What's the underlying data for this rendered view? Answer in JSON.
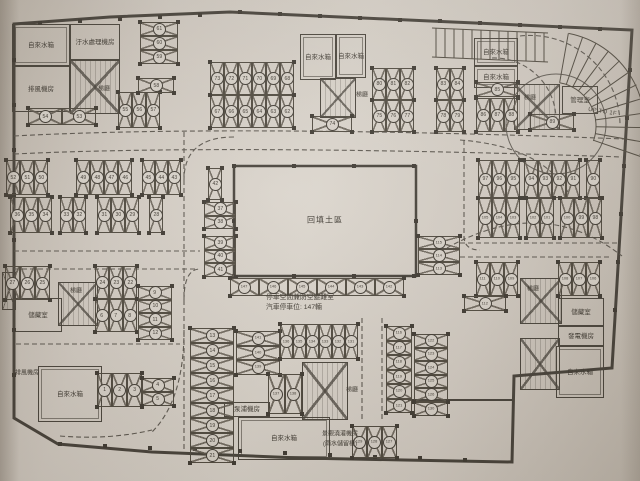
{
  "annotations": {
    "fill_area": "回填土區",
    "shelter": "停車空間兼防空避難室",
    "capacity": "汽車停車位: 147輛",
    "ramp": "UP TO 1F"
  },
  "palette": {
    "paper": "#d6cfc6",
    "ink": "#413c34",
    "dash": "#5b554b"
  },
  "rooms": [
    {
      "label": "自來水箱",
      "x": 12,
      "y": 24,
      "w": 56,
      "h": 40,
      "double": true
    },
    {
      "label": "汙水處理機房",
      "x": 70,
      "y": 24,
      "w": 48,
      "h": 34
    },
    {
      "label": "排風機房",
      "x": 12,
      "y": 66,
      "w": 56,
      "h": 44
    },
    {
      "label": "自來水箱",
      "x": 300,
      "y": 34,
      "w": 34,
      "h": 44,
      "double": true
    },
    {
      "label": "自來水箱",
      "x": 336,
      "y": 34,
      "w": 28,
      "h": 42,
      "double": true
    },
    {
      "label": "自來水箱",
      "x": 474,
      "y": 38,
      "w": 42,
      "h": 26,
      "double": true
    },
    {
      "label": "自來水箱",
      "x": 474,
      "y": 66,
      "w": 42,
      "h": 20,
      "double": true
    },
    {
      "label": "管理室",
      "x": 562,
      "y": 86,
      "w": 34,
      "h": 26
    },
    {
      "label": "儲藏室",
      "x": 558,
      "y": 298,
      "w": 44,
      "h": 26
    },
    {
      "label": "發電機房",
      "x": 558,
      "y": 326,
      "w": 44,
      "h": 18
    },
    {
      "label": "自來水箱",
      "x": 556,
      "y": 346,
      "w": 46,
      "h": 50,
      "double": true
    },
    {
      "label": "儲藏室",
      "x": 14,
      "y": 298,
      "w": 46,
      "h": 32
    },
    {
      "label": "泵浦機房",
      "x": 224,
      "y": 402,
      "w": 44,
      "h": 13
    },
    {
      "label": "自來水箱",
      "x": 238,
      "y": 417,
      "w": 90,
      "h": 41,
      "double": true
    },
    {
      "label": "自來水箱",
      "x": 38,
      "y": 366,
      "w": 62,
      "h": 54,
      "double": true
    }
  ],
  "cores": [
    {
      "x": 70,
      "y": 60,
      "w": 48,
      "h": 52
    },
    {
      "x": 320,
      "y": 78,
      "w": 34,
      "h": 38
    },
    {
      "x": 514,
      "y": 84,
      "w": 44,
      "h": 44
    },
    {
      "x": 520,
      "y": 278,
      "w": 40,
      "h": 44
    },
    {
      "x": 520,
      "y": 338,
      "w": 38,
      "h": 50
    },
    {
      "x": 302,
      "y": 362,
      "w": 44,
      "h": 56
    },
    {
      "x": 58,
      "y": 282,
      "w": 38,
      "h": 42
    },
    {
      "x": 2,
      "y": 272,
      "w": 12,
      "h": 36
    }
  ],
  "labels": [
    {
      "t": "梯廳",
      "x": 104,
      "y": 90
    },
    {
      "t": "梯廳",
      "x": 362,
      "y": 96
    },
    {
      "t": "梯廳",
      "x": 530,
      "y": 99
    },
    {
      "t": "梯廳",
      "x": 533,
      "y": 290
    },
    {
      "t": "梯廳",
      "x": 352,
      "y": 391
    },
    {
      "t": "梯廳",
      "x": 76,
      "y": 292
    },
    {
      "t": "排風機房",
      "x": 27,
      "y": 374
    },
    {
      "t": "景觀澆灌機房",
      "x": 340,
      "y": 435
    },
    {
      "t": "(雨水儲留槽)",
      "x": 340,
      "y": 445
    }
  ],
  "stall_groups": [
    {
      "o": "hr",
      "x": 28,
      "y": 108,
      "sw": 34,
      "sh": 17,
      "nums": [
        "54",
        "53"
      ]
    },
    {
      "o": "v",
      "x": 118,
      "y": 92,
      "sw": 14,
      "len": 36,
      "nums": [
        "55",
        "56",
        "57"
      ]
    },
    {
      "o": "hc",
      "x": 138,
      "y": 78,
      "sw": 36,
      "sh": 15,
      "nums": [
        "58"
      ]
    },
    {
      "o": "hc",
      "x": 140,
      "y": 22,
      "sw": 38,
      "sh": 14,
      "nums": [
        "61",
        "60",
        "59"
      ]
    },
    {
      "o": "v",
      "x": 210,
      "y": 62,
      "sw": 14,
      "len": 33,
      "nums": [
        "73",
        "72",
        "71",
        "70",
        "69",
        "68"
      ]
    },
    {
      "o": "v",
      "x": 210,
      "y": 95,
      "sw": 14,
      "len": 33,
      "nums": [
        "67",
        "66",
        "65",
        "64",
        "63",
        "62"
      ]
    },
    {
      "o": "hr",
      "x": 312,
      "y": 116,
      "sw": 40,
      "sh": 16,
      "nums": [
        "74"
      ]
    },
    {
      "o": "v",
      "x": 372,
      "y": 68,
      "sw": 14,
      "len": 32,
      "nums": [
        "80",
        "81",
        "82"
      ]
    },
    {
      "o": "v",
      "x": 372,
      "y": 100,
      "sw": 14,
      "len": 32,
      "nums": [
        "75",
        "76",
        "77"
      ]
    },
    {
      "o": "v",
      "x": 436,
      "y": 68,
      "sw": 14,
      "len": 32,
      "nums": [
        "83",
        "84"
      ]
    },
    {
      "o": "v",
      "x": 436,
      "y": 100,
      "sw": 14,
      "len": 32,
      "nums": [
        "78",
        "79"
      ]
    },
    {
      "o": "hr",
      "x": 476,
      "y": 82,
      "sw": 42,
      "sh": 15,
      "nums": [
        "85"
      ]
    },
    {
      "o": "v",
      "x": 476,
      "y": 98,
      "sw": 14,
      "len": 34,
      "nums": [
        "86",
        "87",
        "88"
      ]
    },
    {
      "o": "hr",
      "x": 530,
      "y": 114,
      "sw": 44,
      "sh": 16,
      "nums": [
        "89"
      ]
    },
    {
      "o": "v",
      "x": 6,
      "y": 160,
      "sw": 14,
      "len": 35,
      "nums": [
        "52",
        "51",
        "50"
      ]
    },
    {
      "o": "v",
      "x": 76,
      "y": 160,
      "sw": 14,
      "len": 35,
      "nums": [
        "49",
        "48",
        "47",
        "46"
      ]
    },
    {
      "o": "v",
      "x": 142,
      "y": 160,
      "sw": 13,
      "len": 35,
      "nums": [
        "45",
        "44",
        "43"
      ]
    },
    {
      "o": "v",
      "x": 10,
      "y": 197,
      "sw": 14,
      "len": 36,
      "nums": [
        "36",
        "35",
        "34"
      ]
    },
    {
      "o": "v",
      "x": 60,
      "y": 197,
      "sw": 13,
      "len": 36,
      "nums": [
        "33",
        "32"
      ]
    },
    {
      "o": "v",
      "x": 97,
      "y": 197,
      "sw": 14,
      "len": 36,
      "nums": [
        "31",
        "30",
        "29"
      ]
    },
    {
      "o": "v",
      "x": 149,
      "y": 197,
      "sw": 14,
      "len": 36,
      "nums": [
        "28"
      ]
    },
    {
      "o": "v",
      "x": 5,
      "y": 266,
      "sw": 15,
      "len": 34,
      "nums": [
        "27",
        "26",
        "25"
      ]
    },
    {
      "o": "v",
      "x": 95,
      "y": 266,
      "sw": 14,
      "len": 33,
      "nums": [
        "24",
        "23",
        "22"
      ]
    },
    {
      "o": "v",
      "x": 95,
      "y": 299,
      "sw": 14,
      "len": 33,
      "nums": [
        "6",
        "7",
        "8"
      ]
    },
    {
      "o": "hc",
      "x": 138,
      "y": 286,
      "sw": 34,
      "sh": 13.5,
      "nums": [
        "9",
        "10",
        "11",
        "12"
      ]
    },
    {
      "o": "v",
      "x": 97,
      "y": 373,
      "sw": 15,
      "len": 34,
      "nums": [
        "1",
        "2",
        "3"
      ]
    },
    {
      "o": "hc",
      "x": 142,
      "y": 378,
      "sw": 32,
      "sh": 14,
      "nums": [
        "4",
        "5"
      ]
    },
    {
      "o": "hc",
      "x": 190,
      "y": 328,
      "sw": 44,
      "sh": 15,
      "nums": [
        "13",
        "14",
        "15",
        "16",
        "17",
        "18",
        "19",
        "20",
        "21"
      ]
    },
    {
      "o": "hc",
      "x": 236,
      "y": 331,
      "sw": 44,
      "sh": 14.5,
      "nums": [
        "141",
        "140",
        "139"
      ]
    },
    {
      "o": "v",
      "x": 208,
      "y": 168,
      "sw": 14,
      "len": 32,
      "nums": [
        "42"
      ]
    },
    {
      "o": "hc",
      "x": 204,
      "y": 202,
      "sw": 32,
      "sh": 13.5,
      "nums": [
        "37",
        "38"
      ]
    },
    {
      "o": "hc",
      "x": 204,
      "y": 236,
      "sw": 32,
      "sh": 13.5,
      "nums": [
        "39",
        "40",
        "41"
      ]
    },
    {
      "o": "v",
      "x": 230,
      "y": 278,
      "sw": 29,
      "len": 18,
      "nums": [
        "147",
        "146",
        "145",
        "144",
        "143",
        "142"
      ]
    },
    {
      "o": "hc",
      "x": 418,
      "y": 236,
      "sw": 42,
      "sh": 13,
      "nums": [
        "115",
        "114",
        "113"
      ]
    },
    {
      "o": "v",
      "x": 478,
      "y": 160,
      "sw": 14,
      "len": 38,
      "nums": [
        "97",
        "96",
        "95"
      ]
    },
    {
      "o": "v",
      "x": 524,
      "y": 160,
      "sw": 14,
      "len": 38,
      "nums": [
        "94",
        "93",
        "92",
        "91"
      ]
    },
    {
      "o": "v",
      "x": 586,
      "y": 160,
      "sw": 14,
      "len": 38,
      "nums": [
        "90"
      ]
    },
    {
      "o": "v",
      "x": 478,
      "y": 198,
      "sw": 14,
      "len": 40,
      "nums": [
        "105",
        "104",
        "103"
      ]
    },
    {
      "o": "v",
      "x": 526,
      "y": 198,
      "sw": 14,
      "len": 40,
      "nums": [
        "102",
        "101"
      ]
    },
    {
      "o": "v",
      "x": 560,
      "y": 198,
      "sw": 14,
      "len": 40,
      "nums": [
        "100",
        "99",
        "98"
      ]
    },
    {
      "o": "v",
      "x": 476,
      "y": 262,
      "sw": 14,
      "len": 34,
      "nums": [
        "111",
        "110",
        "109"
      ]
    },
    {
      "o": "v",
      "x": 558,
      "y": 262,
      "sw": 14,
      "len": 34,
      "nums": [
        "108",
        "107",
        "106"
      ]
    },
    {
      "o": "hr",
      "x": 464,
      "y": 296,
      "sw": 42,
      "sh": 15,
      "nums": [
        "112"
      ]
    },
    {
      "o": "hc",
      "x": 386,
      "y": 326,
      "sw": 26,
      "sh": 14.5,
      "nums": [
        "116",
        "117",
        "118",
        "119",
        "120",
        "121"
      ]
    },
    {
      "o": "hc",
      "x": 414,
      "y": 334,
      "sw": 34,
      "sh": 13.5,
      "nums": [
        "122",
        "123",
        "124",
        "125",
        "126"
      ]
    },
    {
      "o": "hc",
      "x": 414,
      "y": 402,
      "sw": 34,
      "sh": 14,
      "nums": [
        "130"
      ]
    },
    {
      "o": "v",
      "x": 280,
      "y": 324,
      "sw": 13,
      "len": 35,
      "nums": [
        "136",
        "135",
        "134",
        "133",
        "132",
        "131"
      ]
    },
    {
      "o": "v",
      "x": 268,
      "y": 374,
      "sw": 17,
      "len": 40,
      "nums": [
        "137",
        "138"
      ]
    },
    {
      "o": "v",
      "x": 352,
      "y": 426,
      "sw": 15,
      "len": 32,
      "nums": [
        "129",
        "128",
        "127"
      ]
    }
  ]
}
